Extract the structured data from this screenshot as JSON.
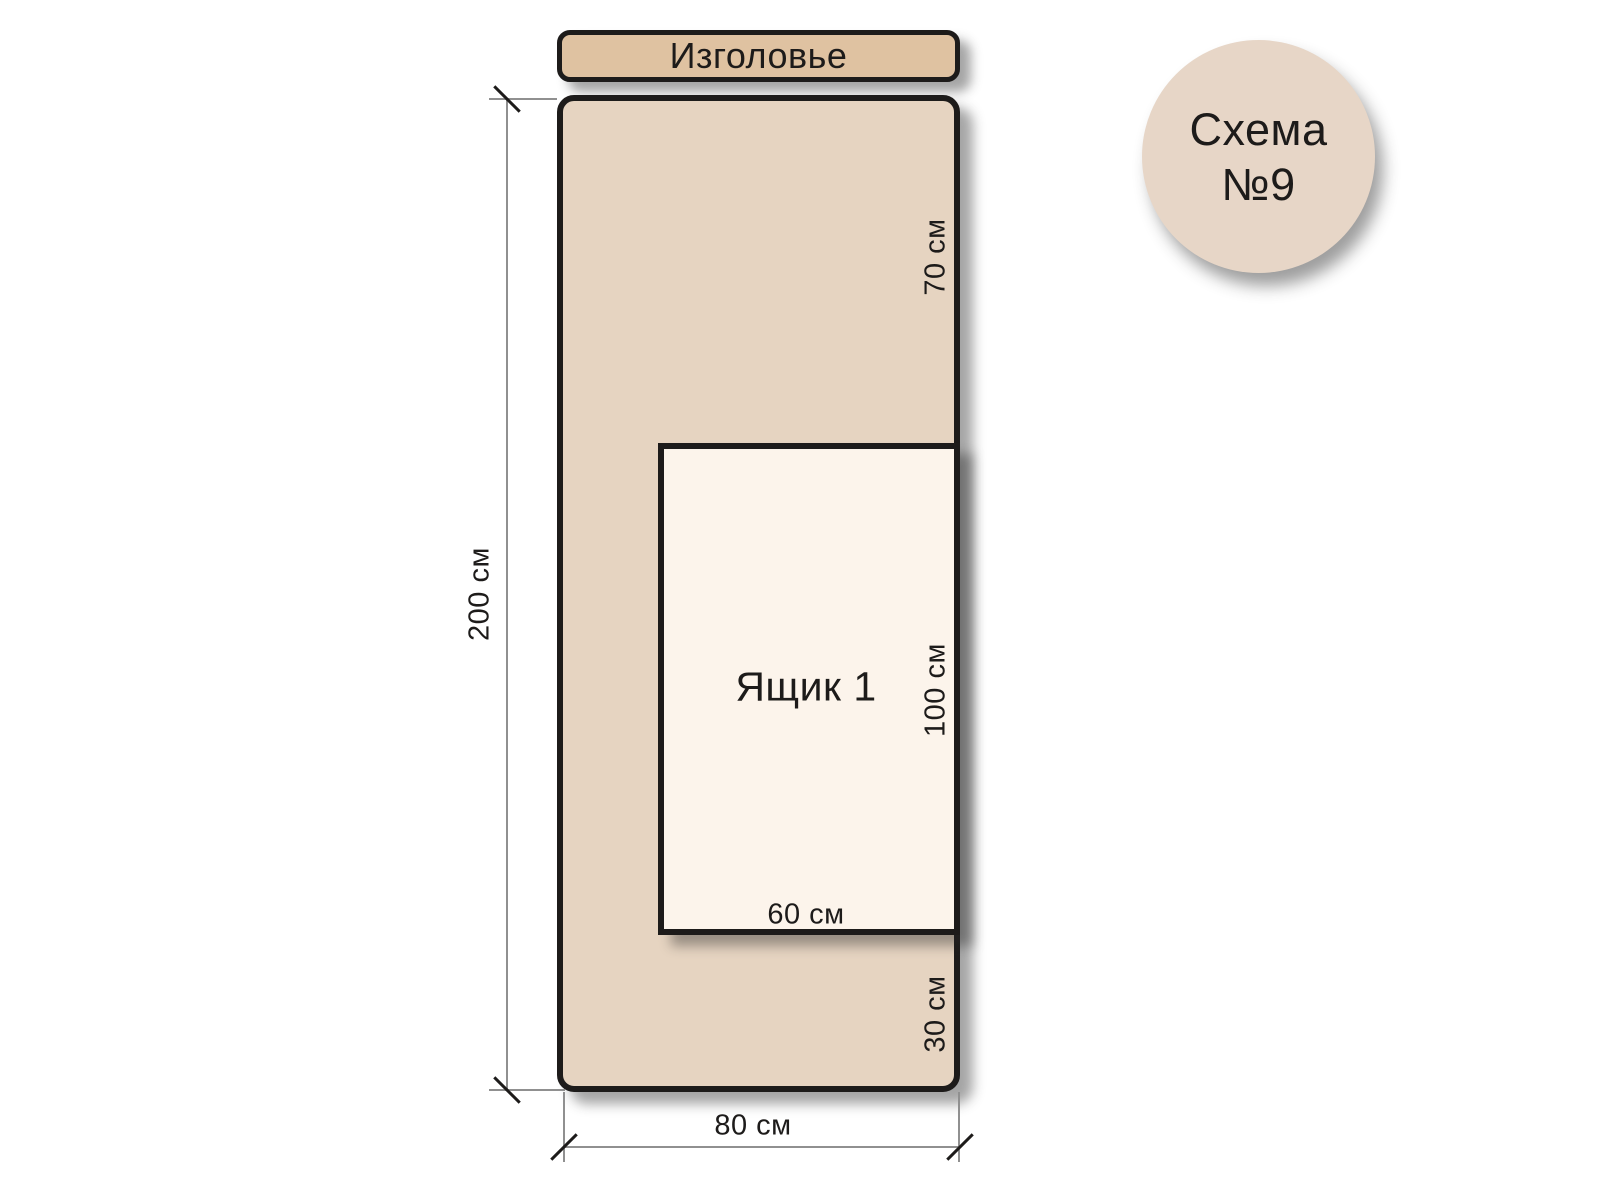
{
  "badge": {
    "line1": "Схема",
    "line2": "№9"
  },
  "headboard": {
    "label": "Изголовье"
  },
  "bed": {
    "height_label": "200 см",
    "width_label": "80 см",
    "top_section_label": "70 см",
    "bottom_section_label": "30 см"
  },
  "drawer": {
    "label": "Ящик 1",
    "height_label": "100 см",
    "width_label": "60 см"
  },
  "colors": {
    "headboard_fill": "#dfc2a1",
    "bed_fill": "#e6d4c1",
    "drawer_fill": "#fcf4eb",
    "badge_fill": "#e7d6c7",
    "outline": "#1d1b1a",
    "dim_line": "#909090",
    "text": "#1d1b1a"
  }
}
